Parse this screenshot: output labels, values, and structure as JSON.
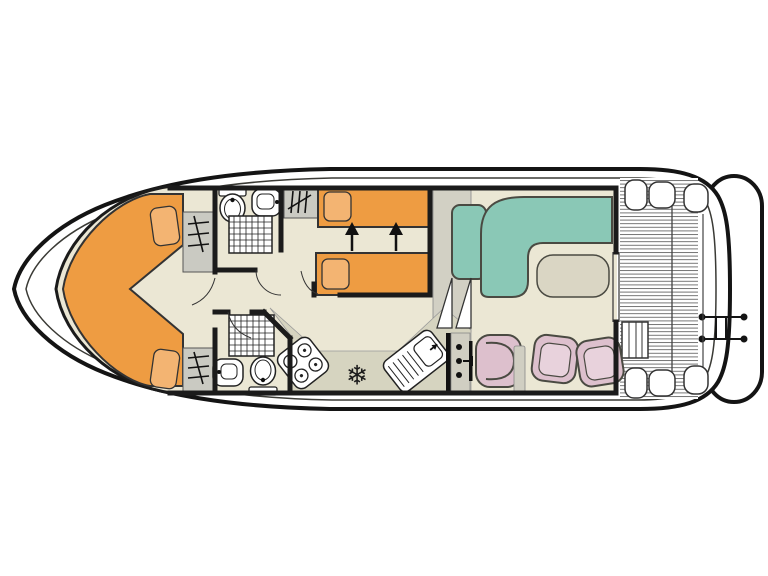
{
  "diagram": {
    "type": "boat-floor-plan",
    "orientation": "bow-left-stern-right",
    "rooms": [
      "bow-cabin",
      "forward-bathroom",
      "aft-bathroom",
      "twin-cabin",
      "corridor",
      "galley",
      "saloon",
      "helm-dinette",
      "rear-deck",
      "swim-platform"
    ],
    "fixtures": [
      "v-shaped-double-bed",
      "two-single-beds",
      "toilet",
      "washbasin",
      "shower",
      "wardrobe",
      "stove-4-burner",
      "fridge",
      "galley-sink",
      "l-shaped-sofa",
      "table",
      "helm-seat",
      "dining-chairs",
      "deck-steps",
      "stairs",
      "swim-ladder",
      "deck-bench"
    ]
  },
  "symbols": {
    "fridge_snowflake": "❄"
  },
  "colors": {
    "hull_white": "#ffffff",
    "hull_line": "#141414",
    "inner_line": "#3a3a35",
    "wall_black": "#1b1b1b",
    "floor_beige": "#EBE7D4",
    "floor_galley": "#D6D4C0",
    "band_gray": "#D2D0C4",
    "console_gray": "#D0CEC2",
    "cabinet_gray": "#CACAC2",
    "table_gray": "#DAD6C4",
    "bed_orange": "#EE9C42",
    "pillow_orange": "#F3B472",
    "sofa_teal": "#8AC8B6",
    "chair_pink": "#DDC0CD",
    "chair_pink_inner": "#E8D2DC",
    "fixture_white": "#ffffff"
  }
}
